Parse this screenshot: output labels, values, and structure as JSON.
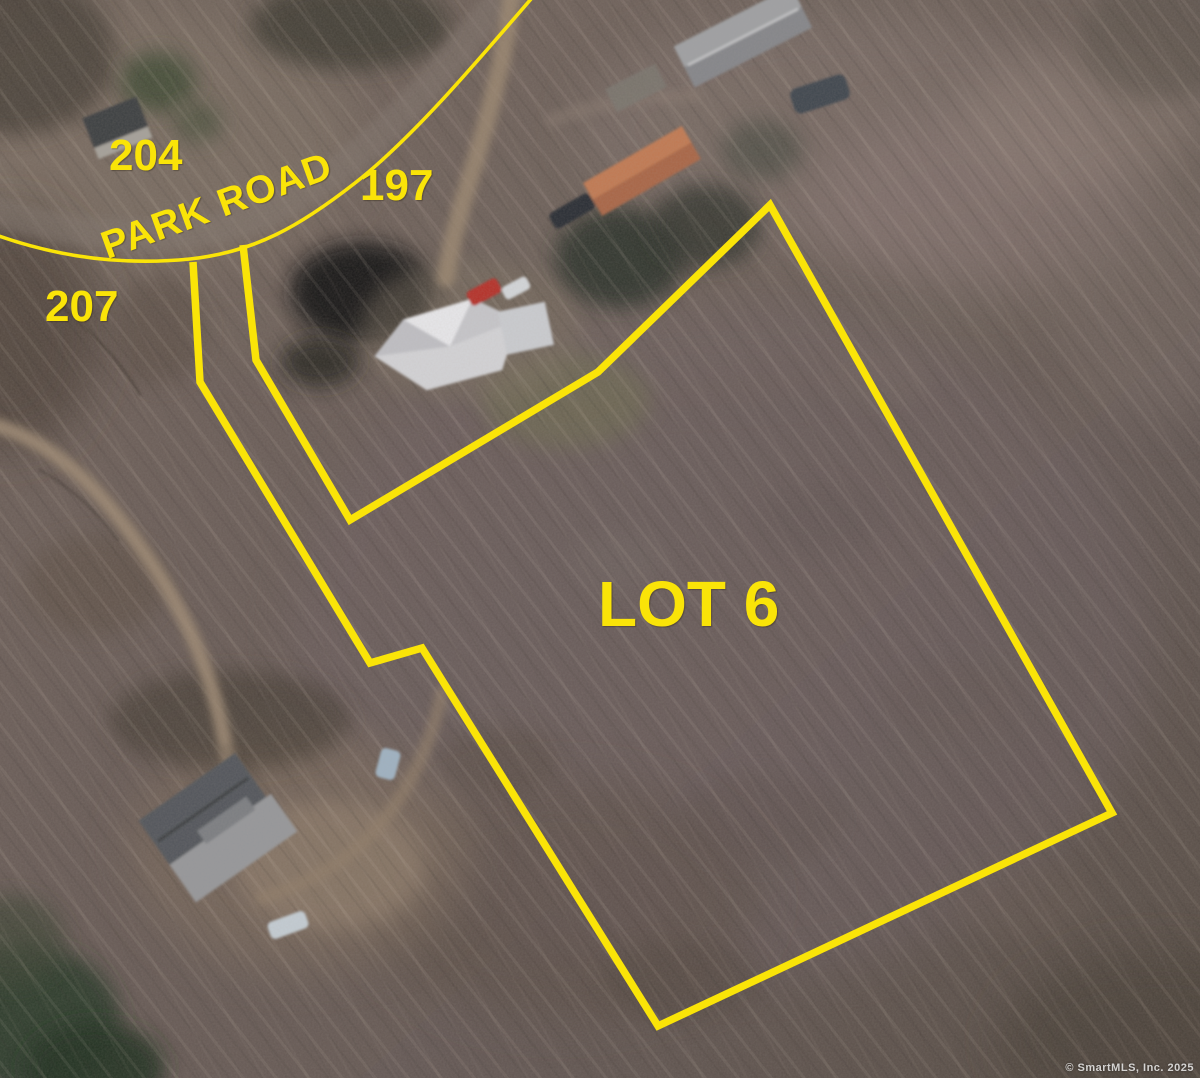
{
  "map_annotations": {
    "road_label": "PARK ROAD",
    "lot_label": "LOT 6",
    "address_labels": {
      "north_of_road": "204",
      "east_of_road": "197",
      "south_of_road": "207"
    },
    "colors": {
      "annotation_yellow": "#FAE408"
    },
    "lot_boundary_points": "193,262 200,382 370,663 422,648 658,1026 1112,813 770,205 598,372 350,520 256,360 243,245",
    "road_curve_path": "M -4 235 C 55 256, 120 266, 190 259 C 255 252, 300 226, 355 183 C 410 140, 470 70, 537 -8"
  },
  "watermark": {
    "text": "© SmartMLS, Inc. 2025"
  }
}
